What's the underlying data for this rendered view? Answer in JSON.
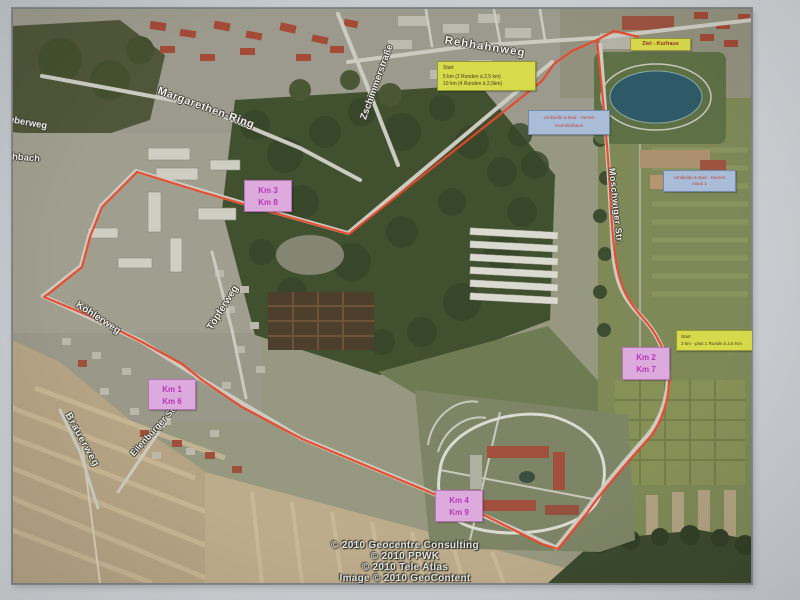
{
  "map": {
    "streets": [
      {
        "name": "Rehhahnweg"
      },
      {
        "name": "Margarethen-Ring"
      },
      {
        "name": "Zschimmerstraße"
      },
      {
        "name": "Töpferweg"
      },
      {
        "name": "Moschwiger Str."
      },
      {
        "name": "Köhlerweg"
      },
      {
        "name": "Brauerweg"
      },
      {
        "name": "Eilenburger Str."
      },
      {
        "name": "eberweg"
      },
      {
        "name": "hbach"
      }
    ],
    "labels": {
      "start_main": {
        "lines": [
          "Start",
          "5 km (2 Runden à 2,5 km)",
          "10 km (4 Runden à 2,5km)"
        ]
      },
      "ziel": {
        "text": "Ziel - Kurhaus"
      },
      "umkleide_herren": {
        "lines": [
          "Umkleide & Bad - Herren",
          "Kurmittelhaus"
        ]
      },
      "umkleide_damen": {
        "lines": [
          "Umkleide & Bad - Damen",
          "Haus 1"
        ]
      },
      "start_3km": {
        "lines": [
          "Start",
          "3 km - plus 1 Runde à 2,5 Km"
        ]
      },
      "km_markers": [
        {
          "line1": "Km 3",
          "line2": "Km 8"
        },
        {
          "line1": "Km 1",
          "line2": "Km 6"
        },
        {
          "line1": "Km 2",
          "line2": "Km 7"
        },
        {
          "line1": "Km 4",
          "line2": "Km 9"
        }
      ]
    },
    "copyright": [
      "© 2010 Geocentre Consulting",
      "© 2010 PPWK",
      "© 2010 Tele Atlas",
      "Image © 2010 GeoContent"
    ],
    "colors": {
      "route": "#e8472b",
      "km_label_bg": "#dcaadc",
      "km_label_text": "#b736b7",
      "yellow_label_bg": "#d7da4b",
      "blue_label_bg": "#a9bdd9",
      "blue_label_text": "#c04838",
      "ziel_text": "#96301f"
    }
  }
}
